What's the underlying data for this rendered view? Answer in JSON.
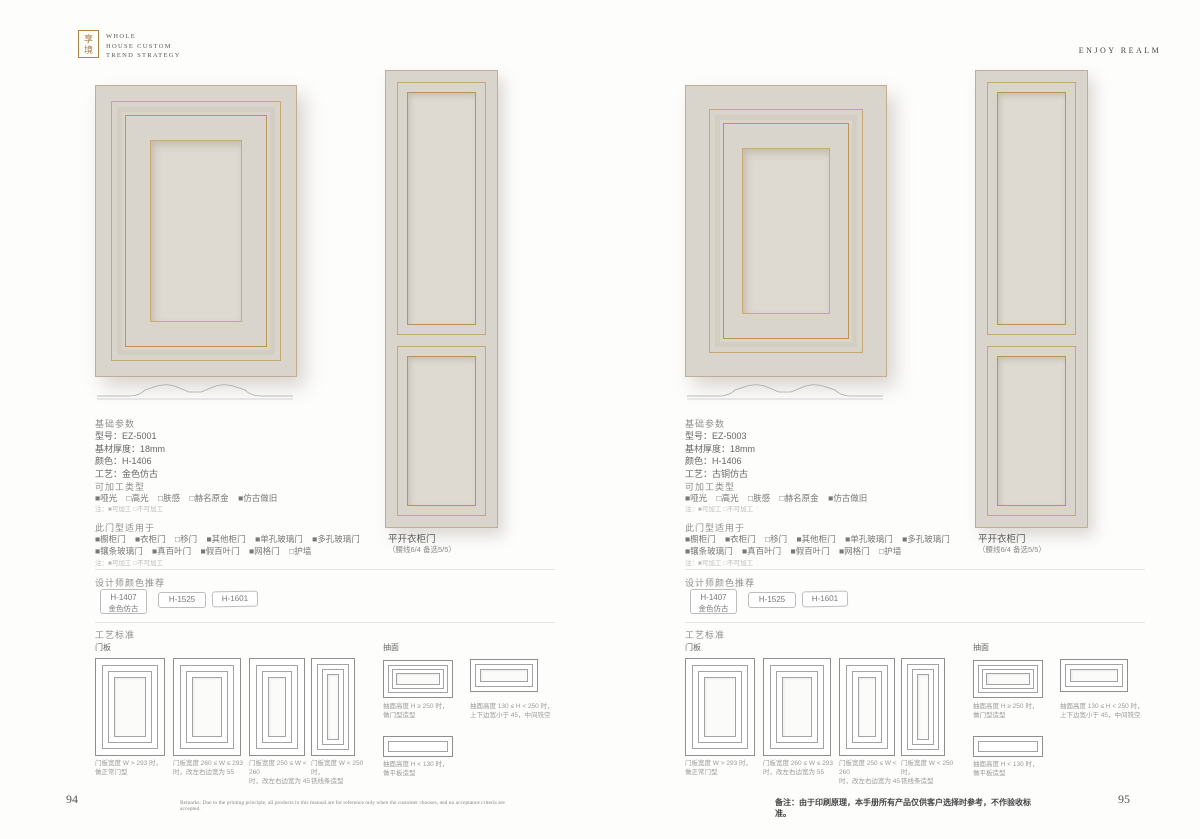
{
  "header": {
    "seal": "享境",
    "logo_lines": [
      "WHOLE",
      "HOUSE CUSTOM",
      "TREND STRATEGY"
    ],
    "right_title": "ENJOY REALM"
  },
  "colors": {
    "door_fill": "#d9d5cc",
    "door_panel": "#dedad2",
    "gold_trim": "#bb935b",
    "seal_gold": "#ad823f"
  },
  "pages": [
    {
      "basic": {
        "title": "基础参数",
        "rows": [
          "型号：EZ-5001",
          "基材厚度：18mm",
          "颜色：H-1406",
          "工艺：金色仿古"
        ]
      },
      "processable": {
        "title": "可加工类型",
        "options": [
          "■哑光",
          "□高光",
          "□肤感",
          "□赫名原金",
          "■仿古做旧"
        ],
        "note": "注：■可加工 □不可加工"
      },
      "applicable": {
        "title": "此门型适用于",
        "row1": [
          "■橱柜门",
          "■衣柜门",
          "□移门",
          "■其他柜门",
          "■单孔玻璃门",
          "■多孔玻璃门"
        ],
        "row2": [
          "■镶条玻璃门",
          "■真百叶门",
          "■假百叶门",
          "■网格门",
          "□护墙"
        ],
        "note": "注：■可加工 □不可加工"
      },
      "door_type": {
        "name": "平开衣柜门",
        "note": "（腰线6/4 备选5/5）"
      },
      "designer": {
        "title": "设计师颜色推荐",
        "chips": [
          {
            "code": "H-1407",
            "label": "金色仿古"
          },
          {
            "code": "H-1525",
            "label": ""
          },
          {
            "code": "H-1601",
            "label": ""
          }
        ]
      },
      "craft": {
        "title": "工艺标准",
        "door_label": "门板",
        "drawer_label": "抽面",
        "door_captions": [
          "门板宽度 W > 293 时，\n做正常门型",
          "门板宽度 260 ≤ W ≤ 293\n时，改左右边宽为 55",
          "门板宽度 250 ≤ W < 260\n时，改左右边宽为 45",
          "门板宽度 W < 250 时，\n铣线条造型"
        ],
        "drawer_captions": [
          "抽面高度 H ≥ 250 时，\n做门型造型",
          "抽面高度 130 ≤ H < 250 时，\n上下边宽小于 45，中间铣空",
          "抽面高度 H < 130 时，\n做平板造型"
        ]
      },
      "page_number": "94",
      "footer_remark": "Remarks: Due to the printing principle, all products in this manual are for reference only when the customer chooses, and no acceptance criteria are accepted."
    },
    {
      "basic": {
        "title": "基础参数",
        "rows": [
          "型号：EZ-5003",
          "基材厚度：18mm",
          "颜色：H-1406",
          "工艺：古铜仿古"
        ]
      },
      "processable": {
        "title": "可加工类型",
        "options": [
          "■哑光",
          "□高光",
          "□肤感",
          "□赫名原金",
          "■仿古做旧"
        ],
        "note": "注：■可加工 □不可加工"
      },
      "applicable": {
        "title": "此门型适用于",
        "row1": [
          "■橱柜门",
          "■衣柜门",
          "□移门",
          "■其他柜门",
          "■单孔玻璃门",
          "■多孔玻璃门"
        ],
        "row2": [
          "■镶条玻璃门",
          "■真百叶门",
          "■假百叶门",
          "■网格门",
          "□护墙"
        ],
        "note": "注：■可加工 □不可加工"
      },
      "door_type": {
        "name": "平开衣柜门",
        "note": "（腰线6/4 备选5/5）"
      },
      "designer": {
        "title": "设计师颜色推荐",
        "chips": [
          {
            "code": "H-1407",
            "label": "金色仿古"
          },
          {
            "code": "H-1525",
            "label": ""
          },
          {
            "code": "H-1601",
            "label": ""
          }
        ]
      },
      "craft": {
        "title": "工艺标准",
        "door_label": "门板",
        "drawer_label": "抽面",
        "door_captions": [
          "门板宽度 W > 293 时，\n做正常门型",
          "门板宽度 260 ≤ W ≤ 293\n时，改左右边宽为 55",
          "门板宽度 250 ≤ W < 260\n时，改左右边宽为 45",
          "门板宽度 W < 250 时，\n铣线条造型"
        ],
        "drawer_captions": [
          "抽面高度 H ≥ 250 时，\n做门型造型",
          "抽面高度 130 ≤ H < 250 时，\n上下边宽小于 45，中间铣空",
          "抽面高度 H < 130 时，\n做平板造型"
        ]
      },
      "page_number": "95",
      "footer_remark": "备注：由于印刷原理，本手册所有产品仅供客户选择时参考，不作验收标准。"
    }
  ]
}
